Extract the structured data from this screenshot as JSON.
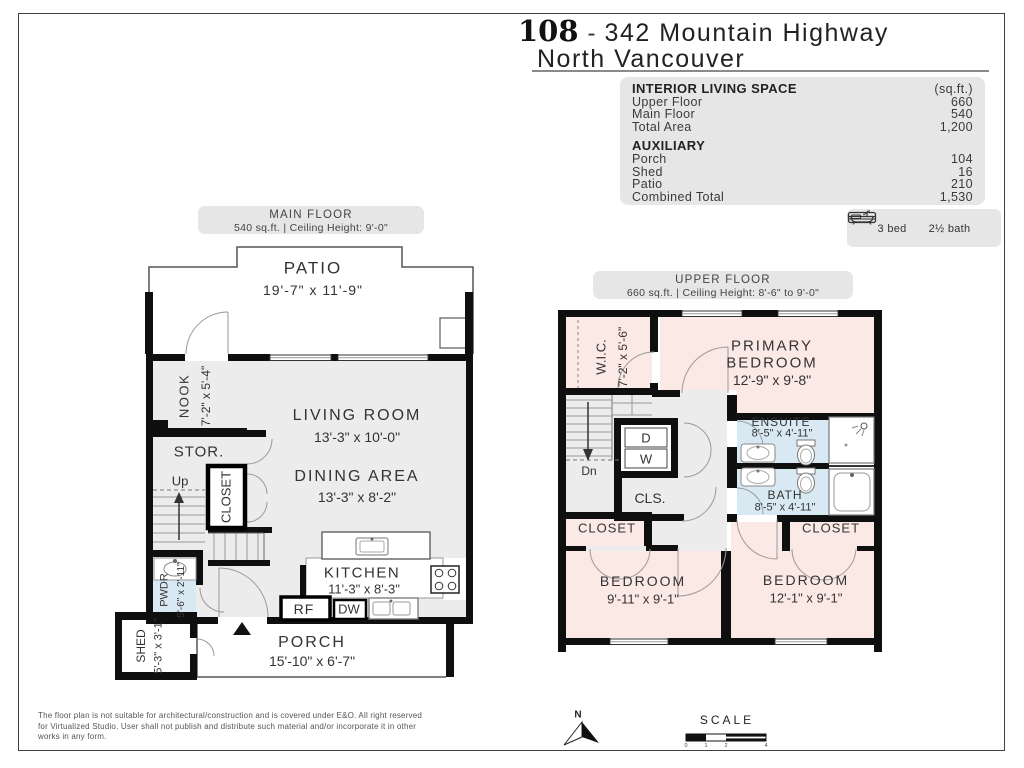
{
  "header": {
    "unit_number": "108",
    "separator": "-",
    "address": "342 Mountain Highway",
    "city": "North Vancouver"
  },
  "summary": {
    "interior": {
      "title": "INTERIOR LIVING SPACE",
      "unit": "(sq.ft.)",
      "rows": [
        {
          "label": "Upper Floor",
          "value": "660"
        },
        {
          "label": "Main Floor",
          "value": "540"
        },
        {
          "label": "Total Area",
          "value": "1,200"
        }
      ]
    },
    "auxiliary": {
      "title": "AUXILIARY",
      "rows": [
        {
          "label": "Porch",
          "value": "104"
        },
        {
          "label": "Shed",
          "value": "16"
        },
        {
          "label": "Patio",
          "value": "210"
        },
        {
          "label": "Combined Total",
          "value": "1,530"
        }
      ]
    },
    "beds_label": "3 bed",
    "baths_label": "2½ bath"
  },
  "main_floor": {
    "title": "MAIN FLOOR",
    "subtitle": "540 sq.ft. | Ceiling Height: 9'-0\"",
    "rooms": {
      "patio": {
        "name": "PATIO",
        "dims": "19'-7\" x 11'-9\""
      },
      "nook": {
        "name": "NOOK",
        "dims": "7'-2\" x 5'-4\""
      },
      "living": {
        "name": "LIVING ROOM",
        "dims": "13'-3\" x 10'-0\""
      },
      "storage": {
        "name": "STOR."
      },
      "stairs_up": {
        "name": "Up"
      },
      "closet": {
        "name": "CLOSET"
      },
      "dining": {
        "name": "DINING AREA",
        "dims": "13'-3\" x 8'-2\""
      },
      "powder": {
        "name": "PWDR",
        "dims": "5'-6\" x 2'-11\""
      },
      "kitchen": {
        "name": "KITCHEN",
        "dims": "11'-3\" x 8'-3\""
      },
      "fridge": {
        "name": "RF"
      },
      "dishwasher": {
        "name": "DW"
      },
      "shed": {
        "name": "SHED",
        "dims": "5'-3\" x 3'-1\""
      },
      "porch": {
        "name": "PORCH",
        "dims": "15'-10\" x 6'-7\""
      }
    }
  },
  "upper_floor": {
    "title": "UPPER FLOOR",
    "subtitle": "660 sq.ft. | Ceiling Height: 8'-6\" to 9'-0\"",
    "rooms": {
      "wic": {
        "name": "W.I.C.",
        "dims": "7'-2\" x 5'-6\""
      },
      "primary": {
        "name_line1": "PRIMARY",
        "name_line2": "BEDROOM",
        "dims": "12'-9\" x 9'-8\""
      },
      "stairs_dn": {
        "name": "Dn"
      },
      "dryer": {
        "name": "D"
      },
      "washer": {
        "name": "W"
      },
      "cls": {
        "name": "CLS."
      },
      "ensuite": {
        "name": "ENSUITE",
        "dims": "8'-5\" x 4'-11\""
      },
      "bath": {
        "name": "BATH",
        "dims": "8'-5\" x 4'-11\""
      },
      "closet_left": {
        "name": "CLOSET"
      },
      "closet_right": {
        "name": "CLOSET"
      },
      "bedroom_left": {
        "name": "BEDROOM",
        "dims": "9'-11\" x 9'-1\""
      },
      "bedroom_right": {
        "name": "BEDROOM",
        "dims": "12'-1\" x 9'-1\""
      }
    }
  },
  "footer": {
    "disclaimer": "The floor plan is not suitable for architectural/construction and is covered under E&O. All right reserved\nfor Virtualized Studio. User shall not publish and distribute such material and/or incorporate it in other\nworks in any form.",
    "north_label": "N",
    "scale_label": "SCALE",
    "scale_ticks": [
      "0",
      "1",
      "2",
      "4"
    ]
  },
  "colors": {
    "wall": "#0f0f0f",
    "floor": "#ececec",
    "room_pink": "#fbe9e5",
    "wet_blue": "#d9e9f3",
    "panel": "#e6e6e6"
  }
}
